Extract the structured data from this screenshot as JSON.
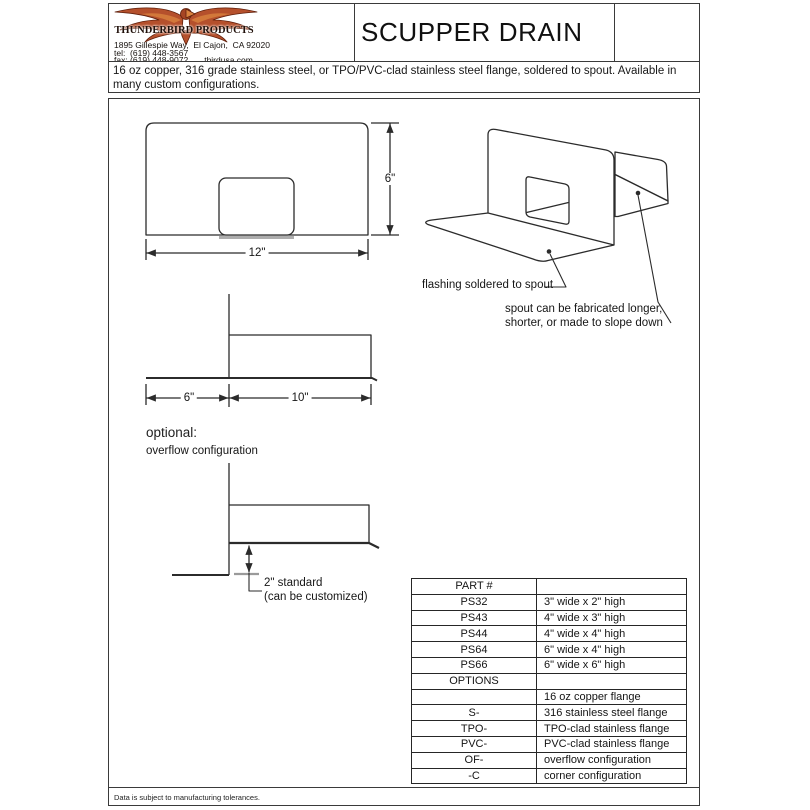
{
  "header": {
    "company": "THUNDERBIRD PRODUCTS",
    "address": "1895 Gillespie Way,  El Cajon,  CA 92020",
    "tel": "tel:  (619) 448-3567",
    "fax": "fax: (619) 448-9072",
    "website": "tbirdusa.com",
    "title": "SCUPPER DRAIN"
  },
  "description": "16 oz copper, 316 grade stainless steel, or TPO/PVC-clad stainless steel flange, soldered to spout. Available in many custom configurations.",
  "drawings": {
    "front_view": {
      "width_label": "12\"",
      "height_label": "6\""
    },
    "side_view": {
      "flange_label": "6\"",
      "spout_label": "10\""
    },
    "perspective": {
      "note_flashing": "flashing soldered to spout",
      "note_spout_line1": "spout can be fabricated longer,",
      "note_spout_line2": "shorter, or made to slope down"
    },
    "overflow": {
      "heading": "optional:",
      "subheading": "overflow configuration",
      "dim_line1": "2\" standard",
      "dim_line2": "(can be customized)"
    }
  },
  "parts_table": {
    "rows": [
      {
        "part": "PART #",
        "desc": ""
      },
      {
        "part": "PS32",
        "desc": "3\" wide x 2\" high"
      },
      {
        "part": "PS43",
        "desc": "4\" wide x 3\" high"
      },
      {
        "part": "PS44",
        "desc": "4\" wide x 4\" high"
      },
      {
        "part": "PS64",
        "desc": "6\" wide x 4\" high"
      },
      {
        "part": "PS66",
        "desc": "6\" wide x 6\" high"
      },
      {
        "part": "OPTIONS",
        "desc": ""
      },
      {
        "part": "",
        "desc": "16 oz copper flange"
      },
      {
        "part": "S-",
        "desc": "316 stainless steel flange"
      },
      {
        "part": "TPO-",
        "desc": "TPO-clad stainless flange"
      },
      {
        "part": "PVC-",
        "desc": "PVC-clad stainless flange"
      },
      {
        "part": "OF-",
        "desc": "overflow configuration"
      },
      {
        "part": "-C",
        "desc": "corner configuration"
      }
    ]
  },
  "footer": "Data is subject to manufacturing tolerances.",
  "colors": {
    "line": "#2b2b2b",
    "logo_red": "#b5502c",
    "logo_dark": "#5f1f0b",
    "gray_tick": "#9a9a9a"
  }
}
